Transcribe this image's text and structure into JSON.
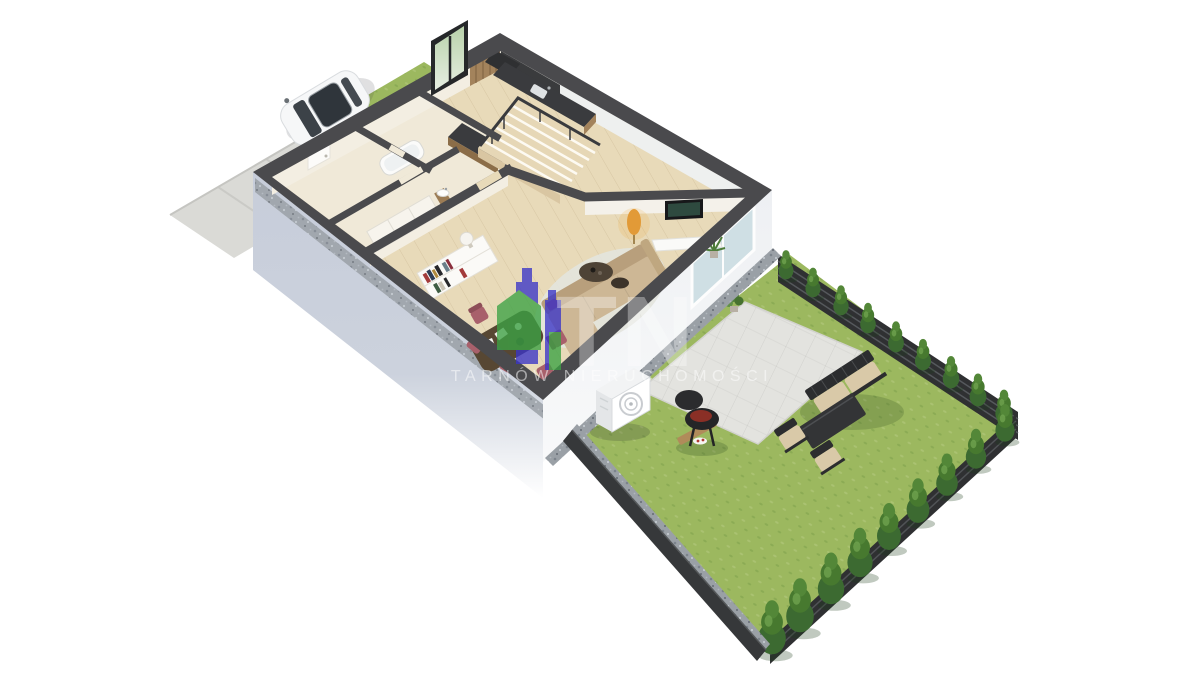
{
  "watermark": {
    "monogram": "TN",
    "caption": "TARNÓW NIERUCHOMOŚCI"
  },
  "palette": {
    "wall-cap": "#4a4a4d",
    "wall-cream": "#f3eee2",
    "wall-face": "#c7cdda",
    "facade-white": "#eef0f3",
    "floor-wood": "#e8dab9",
    "floor-hall": "#f0e9d8",
    "grass": "#9cb85f",
    "hedge": "#47792f",
    "hedge-dark": "#3c6a31",
    "fence": "#2f3032",
    "paver": "#e3e3df",
    "driveway": "#dadad6",
    "walkway": "#e9e7e0",
    "gravel": "#9aa0a6",
    "sofa": "#cdb795",
    "cushion": "#d9c9a8",
    "chair": "#a8606b",
    "table-dark": "#574733",
    "counter": "#3a3b3e",
    "wood-accent": "#a3835c",
    "metal": "#2c2d2f",
    "lamp": "#e29a37",
    "glass": "#cfdfe4",
    "car": "#f6f7f8",
    "logo-blue": "#3a35c8",
    "logo-green": "#3ca244"
  }
}
